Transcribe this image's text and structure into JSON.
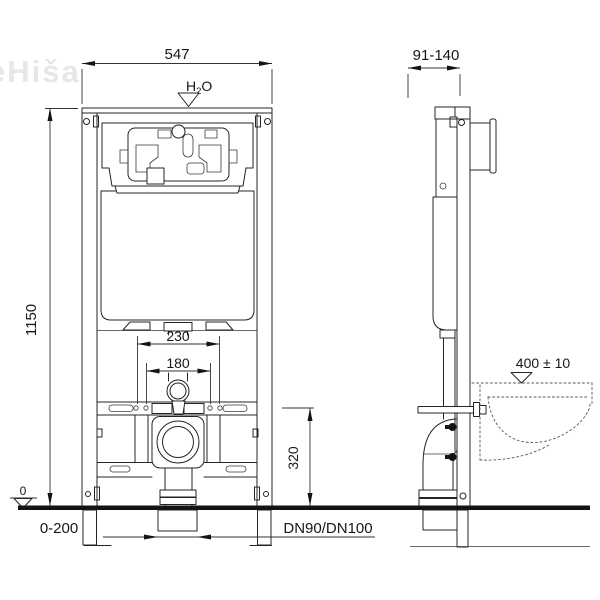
{
  "watermark": "eHiša",
  "front_view": {
    "dim_width_top": "547",
    "water_supply_h": "H",
    "water_supply_sub": "2",
    "water_supply_o": "O",
    "dim_height_left": "1150",
    "dim_bolt_spacing_outer": "230",
    "dim_bolt_spacing_inner": "180",
    "dim_outlet_height": "320",
    "floor_zero_marker": "0",
    "dim_leg_adjust_range": "0-200",
    "drain_pipe_size": "DN90/DN100"
  },
  "side_view": {
    "dim_depth_range": "91-140",
    "dim_bowl_height": "400 ± 10"
  }
}
